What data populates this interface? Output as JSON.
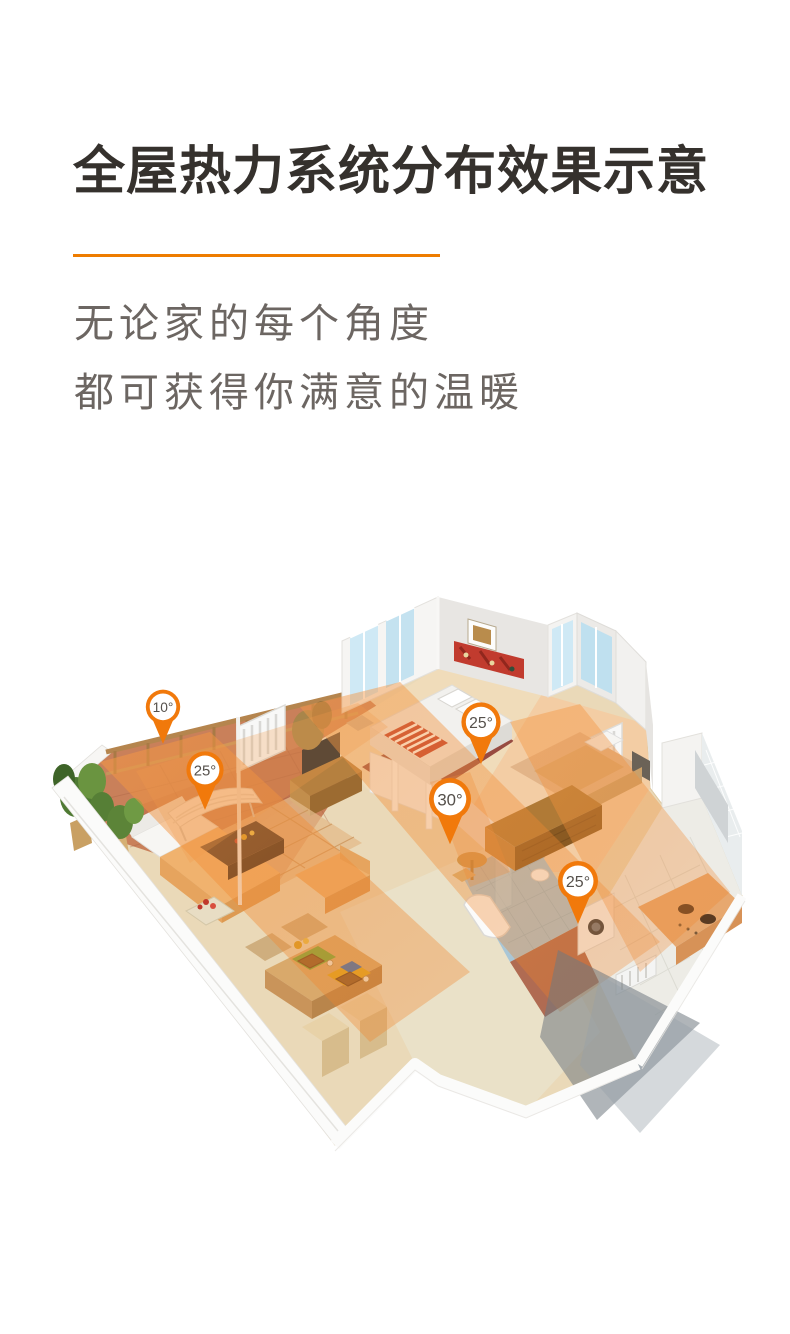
{
  "header": {
    "title": "全屋热力系统分布效果示意",
    "divider_color": "#ee7c00"
  },
  "subtitle": {
    "line1": "无论家的每个角度",
    "line2": "都可获得你满意的温暖"
  },
  "illustration": {
    "description": "isometric cutaway apartment showing whole-house heating distribution with temperature pins",
    "pins": [
      {
        "id": "pin-1",
        "label": "10°",
        "x": 163,
        "y": 706
      },
      {
        "id": "pin-2",
        "label": "25°",
        "x": 205,
        "y": 769
      },
      {
        "id": "pin-3",
        "label": "25°",
        "x": 481,
        "y": 721
      },
      {
        "id": "pin-4",
        "label": "30°",
        "x": 450,
        "y": 798
      },
      {
        "id": "pin-5",
        "label": "25°",
        "x": 578,
        "y": 880
      }
    ],
    "colors": {
      "pin_orange": "#f1790b",
      "pin_text": "#55504b",
      "heat_overlay": "#f08a38",
      "balcony_terracotta": "#c9805a",
      "wood_floor": "#eed7ae",
      "hall_beige": "#eae1c8",
      "bath_blue": "#a9c6d6",
      "kitchen_floor": "#edece6",
      "wall_white": "#f7f6f4",
      "shadow_gray": "#6f7880"
    }
  }
}
